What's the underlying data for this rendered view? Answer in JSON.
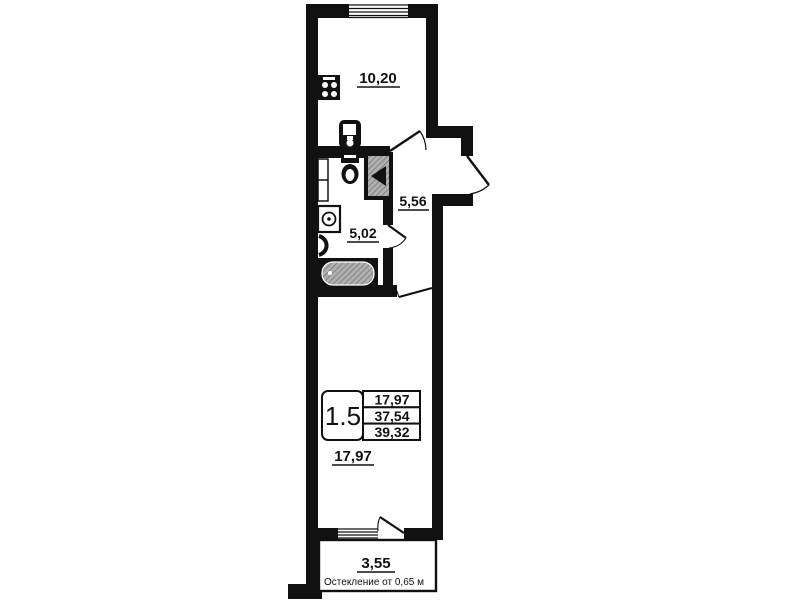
{
  "plan": {
    "title": "apartment-floor-plan",
    "rooms": [
      {
        "id": "kitchen-living",
        "area": "10,20"
      },
      {
        "id": "hallway",
        "area": "5,56"
      },
      {
        "id": "bathroom",
        "area": "5,02"
      },
      {
        "id": "living-room",
        "area": "17,97"
      },
      {
        "id": "balcony",
        "area": "3,55"
      }
    ],
    "info_table": {
      "apartment_type": "1.5",
      "living_area": "17,97",
      "apartment_area": "37,54",
      "total_area": "39,32"
    },
    "note": "Остекление от 0,65 м",
    "colors": {
      "ink": "#111111",
      "background": "#ffffff",
      "hatch_fill": "#b0b0b0",
      "hatch_line": "#6e6e6e"
    }
  }
}
